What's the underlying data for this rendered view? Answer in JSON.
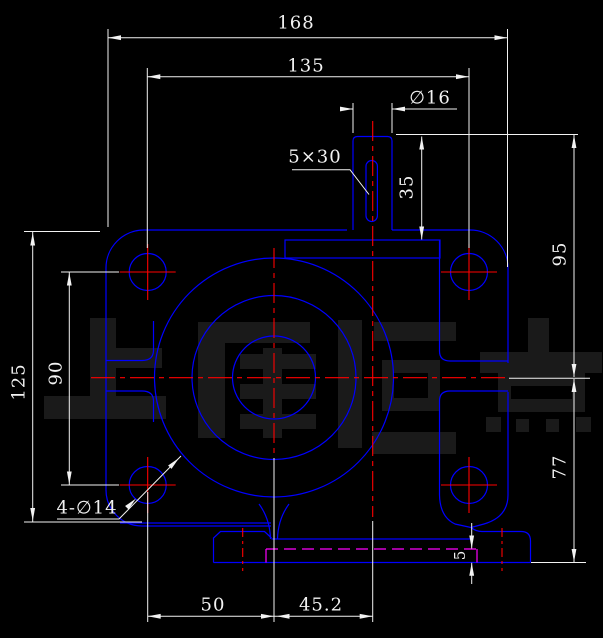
{
  "app": {
    "type": "cad-drawing-viewport",
    "part": "worm-gearbox-housing-front-view"
  },
  "watermark": {
    "text": "上海恒点"
  },
  "colors": {
    "background": "#000000",
    "part_outline": "#0000ff",
    "centerline": "#ff0000",
    "hidden_line": "#ff00ff",
    "dimension": "#f2f2f2",
    "watermark": "#1a1a1a"
  },
  "dims": {
    "d168": "168",
    "d135": "135",
    "d16": "∅16",
    "d5x30": "5×30",
    "d35": "35",
    "d95": "95",
    "d77": "77",
    "d125": "125",
    "d90": "90",
    "d50": "50",
    "d45_2": "45.2",
    "d5": "5",
    "d4d14": "4-∅14"
  }
}
